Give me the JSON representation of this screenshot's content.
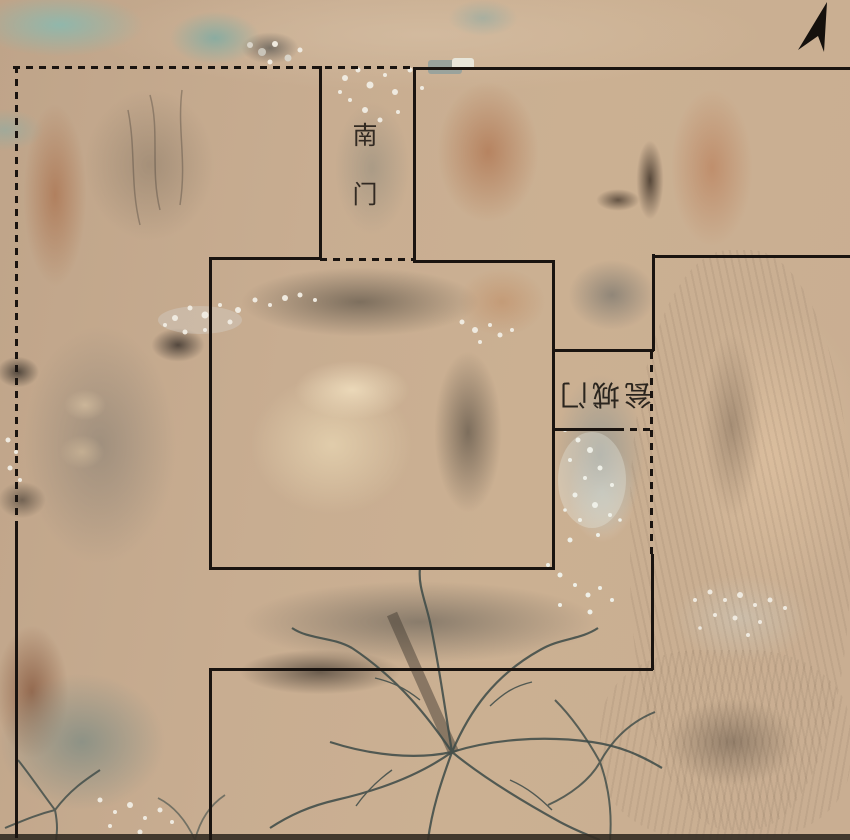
{
  "figure": {
    "labels": {
      "south_gate": "南门",
      "barbican_gate": "瓮城门"
    },
    "icons": {
      "north_arrow": "north-arrow-icon"
    },
    "colors": {
      "annotation_line": "#1a1410",
      "sand_base": "#c6ab8f",
      "teal_patch": "#8eb8ad",
      "excavation_grey": "#968a7c",
      "label_text": "#2a231c"
    }
  }
}
